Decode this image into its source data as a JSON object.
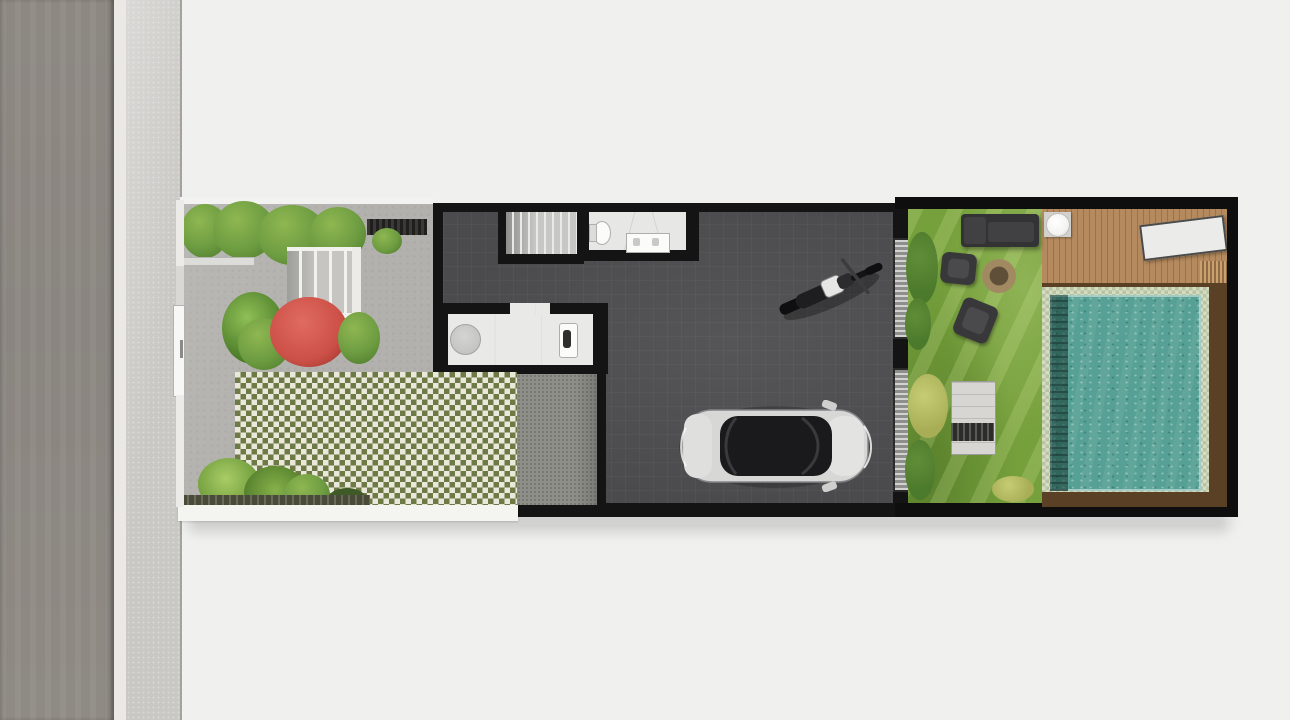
{
  "scene": {
    "type": "architectural-site-plan-render",
    "view": "top-down",
    "orientation": "street on the left, lot runs horizontally",
    "zones": [
      {
        "name": "street",
        "items": [
          "asphalt road",
          "curb",
          "sidewalk"
        ]
      },
      {
        "name": "front-garden",
        "items": [
          "white fence with gate",
          "hedge planter",
          "entry steps",
          "slatted bench",
          "red flowering bush",
          "tropical plants",
          "grass-block checker paving",
          "palm and fern plants",
          "white planter band"
        ]
      },
      {
        "name": "house",
        "items": [
          "staircase",
          "bathroom with toilet and vanity",
          "kitchen with round table and sink",
          "service yard",
          "foyer",
          "black perimeter walls"
        ]
      },
      {
        "name": "garage",
        "items": [
          "parked car (top view)",
          "parked motorcycle (top view)",
          "glass sliding doors to backyard"
        ]
      },
      {
        "name": "backyard",
        "items": [
          "lawn",
          "dark sofa",
          "two armchairs",
          "fire pit",
          "slatted garden bench-table",
          "shrubs",
          "wooden deck",
          "round white table",
          "sun lounger",
          "deck stairs",
          "swimming pool with tile border and dark ledge",
          "brown pool surround"
        ]
      }
    ]
  },
  "palette": {
    "bg": "#f0f0ef",
    "road": "#8b8681",
    "curb": "#eae9e6",
    "sidewalk": "#c9c8c4",
    "paving": "#b2b1ad",
    "wall": "#141414",
    "floor": "#4b4b4d",
    "stair": "#c4c4c2",
    "bath_floor": "#e7e7e5",
    "kitchen_floor": "#e9e9e7",
    "service": "#8f8f8a",
    "checker_olive": "#6e7a45",
    "checker_cream": "#e9e8db",
    "hedge": "#6d9c41",
    "hedge_dark": "#4f7d2e",
    "hedge_light": "#8fb751",
    "red_bush": "#cc5047",
    "grass": "#76a03c",
    "bush_dark": "#4c7a2c",
    "bush_yellow": "#a8ae55",
    "deck": "#b48a5e",
    "deck_line": "#9c7249",
    "pool_tile_a": "#d5dcc2",
    "pool_tile_b": "#b8c3a3",
    "pool_water": "#57a095",
    "pool_surround": "#5a4126",
    "sofa": "#333335",
    "chair": "#38383a",
    "firepit_ring": "#a18a62",
    "firepit_core": "#5f4f38",
    "lounger": "#ebebe9",
    "table_white": "#f3f3f1",
    "bench": "#d7d6d2",
    "fence": "#ecebe8",
    "white_band": "#f4f4f1",
    "soil": "#4a4a38",
    "door_stripe_a": "#d2d2d0",
    "door_stripe_b": "#8e8e8c",
    "car_body": "#d7d7d5",
    "car_glass": "#1a1a1c",
    "moto_tank": "#e6e6e4"
  }
}
